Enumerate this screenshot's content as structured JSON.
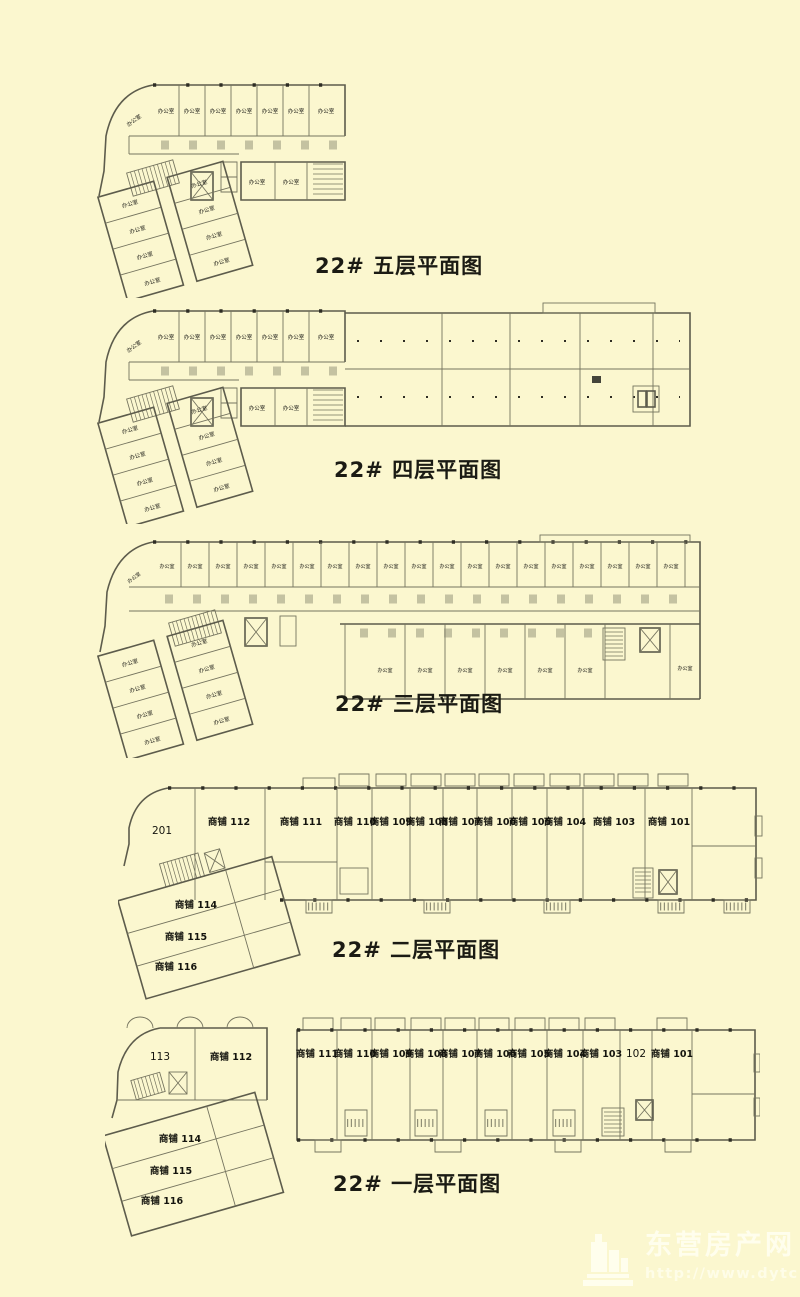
{
  "page": {
    "background": "#FBF7CF",
    "wall_color": "#5d5c4c",
    "text_color": "#1b1b14"
  },
  "labels": {
    "office": "办公室"
  },
  "titles": {
    "floor5": "22# 五层平面图",
    "floor4": "22# 四层平面图",
    "floor3": "22# 三层平面图",
    "floor2": "22# 二层平面图",
    "floor1": "22# 一层平面图"
  },
  "floor2_rooms": {
    "r201": "201",
    "s112": "商铺 112",
    "s111": "商铺 111",
    "s110": "商铺 110",
    "s109": "商铺 109",
    "s108": "商铺 108",
    "s107": "商铺 107",
    "s106": "商铺 106",
    "s105": "商铺 105",
    "s104": "商铺 104",
    "s103": "商铺 103",
    "s101": "商铺 101",
    "s114": "商铺 114",
    "s115": "商铺 115",
    "s116": "商铺 116"
  },
  "floor1_rooms": {
    "r113": "113",
    "s112": "商铺 112",
    "s111": "商铺 111",
    "s110": "商铺 110",
    "s109": "商铺 109",
    "s108": "商铺 108",
    "s107": "商铺 107",
    "s106": "商铺 106",
    "s105": "商铺 105",
    "s104": "商铺 104",
    "s103": "商铺 103",
    "r102": "102",
    "s101": "商铺 101",
    "s114": "商铺 114",
    "s115": "商铺 115",
    "s116": "商铺 116"
  },
  "watermark": {
    "name": "东营房产网",
    "url": "http://www.dytc.net"
  }
}
